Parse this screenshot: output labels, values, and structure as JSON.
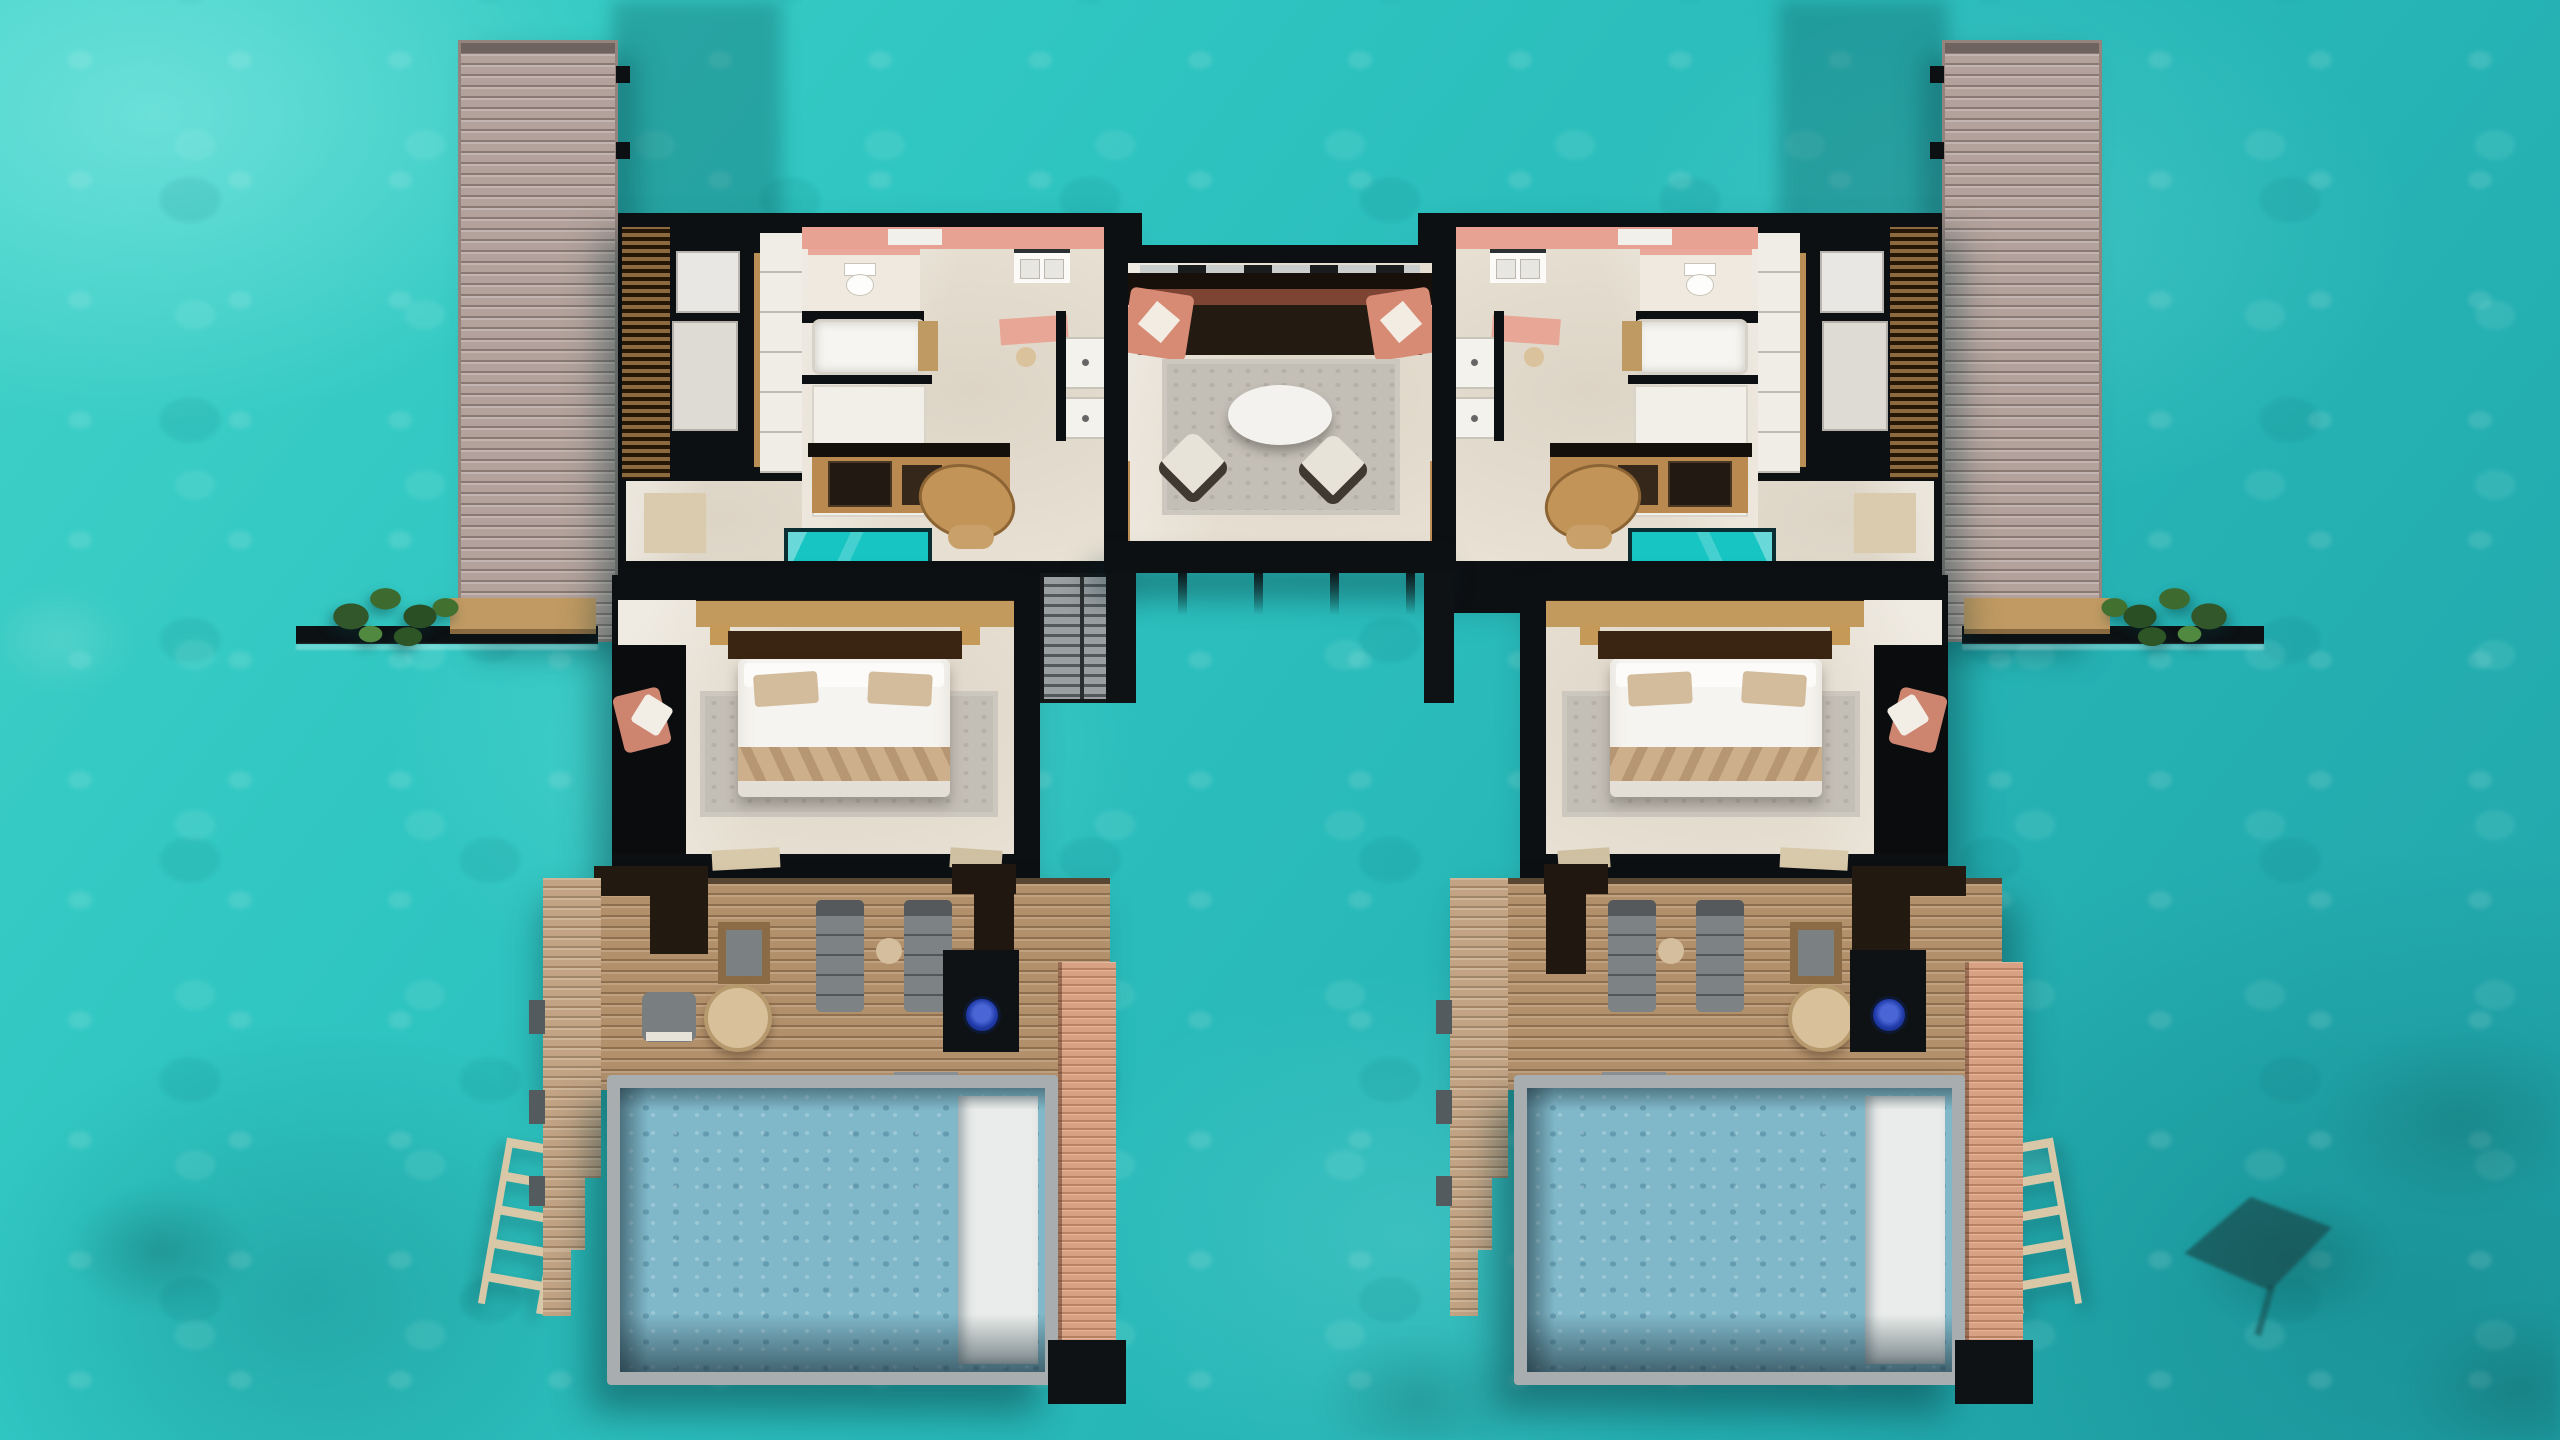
{
  "scene": {
    "type": "aerial top-down 3D floor plan render",
    "setting": "two mirrored overwater pool villas joined by a central lounge pavilion, turquoise lagoon",
    "visible_text": "none",
    "water": {
      "base_color": "#2fc5c1",
      "light_patches": "#7ce4da",
      "deep_patches": "#1a9fa6",
      "wildlife": "dark eagle-ray silhouette swimming near bottom right"
    },
    "jetties": {
      "count": 2,
      "description": "vertical plank walkways at outer top corners leading to each villa",
      "plank_color": "#b3a29c"
    },
    "villa": {
      "rooms": [
        "louvered dressing room",
        "toilet room",
        "bathtub",
        "walk-in shower pair",
        "double vanity",
        "pink-walled bathroom",
        "kitchenette with minibar counter",
        "oval work table",
        "glass floor viewing panel",
        "king bedroom",
        "overwater daybed nook with salmon cushions",
        "sun deck",
        "private pool with white lounge shelf",
        "stepped side sundeck",
        "swim ladder",
        "side walkway with planter and bench"
      ],
      "bed": {
        "duvet": "#f6f4f0",
        "runner": "#cdb08b",
        "pillows": "#d2bc9b",
        "headboard": "#3a2412"
      },
      "deck_furniture": [
        "two gray sun loungers",
        "round side table",
        "round dining table",
        "square stool",
        "gray lounge chair",
        "dark planter screens"
      ]
    },
    "central_pavilion": {
      "furniture": [
        "long dark sofa with salmon end cushions and white pillows",
        "gray area rug",
        "white oval coffee table",
        "two cream swivel armchairs"
      ],
      "structure": [
        "black perimeter walls",
        "sliding door track",
        "gold door frames",
        "piling posts below"
      ]
    },
    "pools": {
      "count": 2,
      "water_color": "#80b8c9",
      "shelf_color": "#e9ecea",
      "frame_color": "#a8adaf",
      "blue_fixture": "#2745c5"
    },
    "palette": {
      "roof_black": "#0d1013",
      "interior_floor": "#e9e2d5",
      "bathroom_pink": "#e7a294",
      "deck_wood": "#b2906c",
      "peach_wood": "#d8a183",
      "louver_wood": "#7c5a34",
      "accent_salmon": "#d78a74",
      "glass_panel_teal": "#17c5c3",
      "plant_green": "#31572a",
      "furniture_gray": "#7d8284",
      "table_wood": "#c29457"
    },
    "counts": {
      "villas": 2,
      "pools": 2,
      "loungers_per_deck": 2,
      "central_armchairs": 2,
      "ladders": 2,
      "planters": 2
    }
  }
}
